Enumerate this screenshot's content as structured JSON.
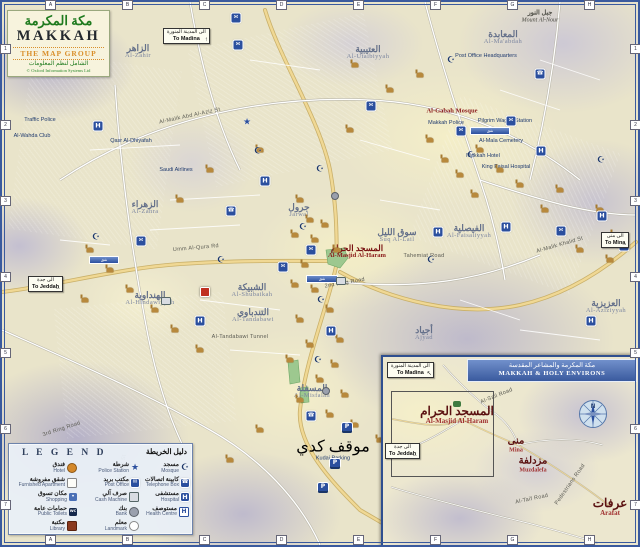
{
  "title_block": {
    "arabic": "مكة المكرمة",
    "english": "MAKKAH",
    "publisher": "THE MAP GROUP",
    "publisher_arabic": "الشامل لنظم المعلومات",
    "copyright": "© Oxford Information Systems Ltd"
  },
  "grid": {
    "top": [
      "A",
      "B",
      "C",
      "D",
      "E",
      "F",
      "G",
      "H"
    ],
    "side": [
      "1",
      "2",
      "3",
      "4",
      "5",
      "6",
      "7"
    ]
  },
  "direction_signs": [
    {
      "ar": "الى المدينة المنورة",
      "en": "To Madina",
      "arrow": "↑",
      "x": 163,
      "y": 28
    },
    {
      "ar": "الى جدة",
      "en": "To Jeddah",
      "arrow": "←",
      "x": 28,
      "y": 276
    },
    {
      "ar": "الى منى",
      "en": "To Mina",
      "arrow": "→",
      "x": 601,
      "y": 232
    }
  ],
  "map_labels": [
    {
      "t": "Al-Zahir",
      "a": "الزاهر",
      "x": 138,
      "y": 52,
      "c": "district",
      "n": "label-al-zahir"
    },
    {
      "t": "Al-Utaibiyyah",
      "a": "العتيبية",
      "x": 368,
      "y": 53,
      "c": "district",
      "n": "label-al-utaibiyyah"
    },
    {
      "t": "Al-Ma'abdah",
      "a": "المعابدة",
      "x": 503,
      "y": 38,
      "c": "district",
      "n": "label-al-maabdah"
    },
    {
      "t": "Mount Al-Nour",
      "a": "جبل النور",
      "x": 540,
      "y": 17,
      "c": "peak",
      "n": "label-mount-al-nour"
    },
    {
      "t": "Al-Zahra",
      "a": "الزهراء",
      "x": 145,
      "y": 208,
      "c": "district",
      "n": "label-al-zahra"
    },
    {
      "t": "Jarwal",
      "a": "جرول",
      "x": 299,
      "y": 211,
      "c": "district",
      "n": "label-jarwal"
    },
    {
      "t": "Suq Al-Lail",
      "a": "سوق الليل",
      "x": 397,
      "y": 236,
      "c": "district",
      "n": "label-suq-al-lail"
    },
    {
      "t": "Al-Shubaikah",
      "a": "الشبيكة",
      "x": 252,
      "y": 291,
      "c": "district",
      "n": "label-al-shubaikah"
    },
    {
      "t": "Al-Hindawiyyah",
      "a": "الهنداوية",
      "x": 150,
      "y": 299,
      "c": "district",
      "n": "label-al-hindawiyyah"
    },
    {
      "t": "Al-Tandabawi",
      "a": "التندباوي",
      "x": 253,
      "y": 316,
      "c": "district",
      "n": "label-al-tandabawi"
    },
    {
      "t": "Al-Misfalah",
      "a": "المسفلة",
      "x": 312,
      "y": 392,
      "c": "district",
      "n": "label-al-misfalah"
    },
    {
      "t": "Ajyad",
      "a": "أجياد",
      "x": 424,
      "y": 334,
      "c": "district",
      "n": "label-ajyad"
    },
    {
      "t": "Al-Faisaliyyah",
      "a": "الفيصلية",
      "x": 469,
      "y": 232,
      "c": "district",
      "n": "label-al-faisaliyyah"
    },
    {
      "t": "Al-Aziziyyah",
      "a": "العزيزية",
      "x": 606,
      "y": 307,
      "c": "district",
      "n": "label-al-aziziyyah"
    },
    {
      "t": "Al-Masjid Al-Haram",
      "a": "المسجد الحرام",
      "x": 357,
      "y": 252,
      "c": "red",
      "n": "label-al-masjid-al-haram"
    },
    {
      "t": "Al-Gabah Mosque",
      "x": 452,
      "y": 112,
      "c": "red",
      "n": "label-al-gabah-mosque"
    },
    {
      "t": "Traffic Police",
      "x": 40,
      "y": 121,
      "c": "poi"
    },
    {
      "t": "Al-Wahda Club",
      "x": 32,
      "y": 137,
      "c": "poi"
    },
    {
      "t": "Qasr Al-Dhiyafah",
      "x": 131,
      "y": 142,
      "c": "poi"
    },
    {
      "t": "Saudi Airlines",
      "x": 176,
      "y": 171,
      "c": "poi"
    },
    {
      "t": "Post Office Headquarters",
      "x": 486,
      "y": 57,
      "c": "poi"
    },
    {
      "t": "Pilgrim Wagon Station",
      "x": 505,
      "y": 122,
      "c": "poi"
    },
    {
      "t": "Makkah Police",
      "x": 446,
      "y": 124,
      "c": "poi"
    },
    {
      "t": "Al-Mala Cemetery",
      "x": 501,
      "y": 142,
      "c": "poi"
    },
    {
      "t": "Makkah Hotel",
      "x": 483,
      "y": 157,
      "c": "poi"
    },
    {
      "t": "King Faisal Hospital",
      "x": 506,
      "y": 168,
      "c": "poi"
    },
    {
      "t": "Kudai Parking",
      "a": "موقف كدي",
      "x": 333,
      "y": 451,
      "c": "poi"
    },
    {
      "t": "2nd Ring Road",
      "x": 345,
      "y": 284,
      "c": "road",
      "r": -10
    },
    {
      "t": "3rd Ring Road",
      "x": 62,
      "y": 430,
      "c": "road",
      "r": -18
    },
    {
      "t": "Umm Al-Qura Rd",
      "x": 196,
      "y": 249,
      "c": "road",
      "r": -5
    },
    {
      "t": "Al-Tandabawi Tunnel",
      "x": 240,
      "y": 338,
      "c": "road"
    },
    {
      "t": "Tahemiat Road",
      "x": 424,
      "y": 257,
      "c": "road"
    },
    {
      "t": "Al-Malik Khalid St",
      "x": 560,
      "y": 246,
      "c": "road",
      "r": -16
    },
    {
      "t": "Al-Mansur St",
      "x": 122,
      "y": 472,
      "c": "road",
      "r": -78
    },
    {
      "t": "Al-Malik Abd Al-Aziz St",
      "x": 190,
      "y": 117,
      "c": "road",
      "r": -12
    }
  ],
  "tunnel_bars": [
    {
      "t": "نفق",
      "x": 322,
      "y": 279,
      "w": 30
    },
    {
      "t": "نفق",
      "x": 104,
      "y": 260,
      "w": 28
    },
    {
      "t": "نفق",
      "x": 490,
      "y": 131,
      "w": 38
    }
  ],
  "markers": {
    "facilities": [
      {
        "t": "post",
        "x": 238,
        "y": 45
      },
      {
        "t": "police",
        "x": 247,
        "y": 123
      },
      {
        "t": "mosque",
        "x": 258,
        "y": 152
      },
      {
        "t": "hospital",
        "x": 265,
        "y": 181
      },
      {
        "t": "mosque",
        "x": 320,
        "y": 170
      },
      {
        "t": "bank",
        "x": 335,
        "y": 196
      },
      {
        "t": "mosque",
        "x": 303,
        "y": 228
      },
      {
        "t": "post",
        "x": 311,
        "y": 250
      },
      {
        "t": "cash",
        "x": 341,
        "y": 281
      },
      {
        "t": "mosque",
        "x": 321,
        "y": 301
      },
      {
        "t": "hospital",
        "x": 331,
        "y": 331
      },
      {
        "t": "mosque",
        "x": 318,
        "y": 361
      },
      {
        "t": "bank",
        "x": 326,
        "y": 391
      },
      {
        "t": "phone",
        "x": 311,
        "y": 416
      },
      {
        "t": "hospital",
        "x": 200,
        "y": 321
      },
      {
        "t": "hospital",
        "x": 98,
        "y": 126
      },
      {
        "t": "post",
        "x": 141,
        "y": 241
      },
      {
        "t": "mosque",
        "x": 221,
        "y": 261
      },
      {
        "t": "post",
        "x": 461,
        "y": 131
      },
      {
        "t": "mosque",
        "x": 471,
        "y": 156
      },
      {
        "t": "post",
        "x": 511,
        "y": 121
      },
      {
        "t": "hospital",
        "x": 541,
        "y": 151
      },
      {
        "t": "mosque",
        "x": 601,
        "y": 161
      },
      {
        "t": "post",
        "x": 561,
        "y": 231
      },
      {
        "t": "hospital",
        "x": 591,
        "y": 321
      },
      {
        "t": "mosque",
        "x": 431,
        "y": 261
      },
      {
        "t": "post",
        "x": 371,
        "y": 106
      },
      {
        "t": "mosque",
        "x": 451,
        "y": 61
      },
      {
        "t": "phone",
        "x": 231,
        "y": 211
      },
      {
        "t": "cash",
        "x": 166,
        "y": 301
      },
      {
        "t": "hospital",
        "x": 438,
        "y": 232
      },
      {
        "t": "post",
        "x": 283,
        "y": 267
      },
      {
        "t": "parking",
        "x": 347,
        "y": 427
      },
      {
        "t": "parking",
        "x": 335,
        "y": 463
      },
      {
        "t": "parking",
        "x": 323,
        "y": 487
      },
      {
        "t": "parkred",
        "x": 205,
        "y": 292
      },
      {
        "t": "hospital",
        "x": 602,
        "y": 216
      },
      {
        "t": "post",
        "x": 624,
        "y": 246
      },
      {
        "t": "mosque",
        "x": 96,
        "y": 238
      },
      {
        "t": "phone",
        "x": 540,
        "y": 74
      },
      {
        "t": "post",
        "x": 236,
        "y": 18
      },
      {
        "t": "hospital",
        "x": 506,
        "y": 227
      }
    ],
    "mosques": [
      [
        300,
        200
      ],
      [
        310,
        220
      ],
      [
        295,
        235
      ],
      [
        315,
        240
      ],
      [
        325,
        225
      ],
      [
        305,
        265
      ],
      [
        295,
        285
      ],
      [
        315,
        290
      ],
      [
        330,
        310
      ],
      [
        300,
        320
      ],
      [
        340,
        340
      ],
      [
        310,
        345
      ],
      [
        290,
        360
      ],
      [
        335,
        365
      ],
      [
        320,
        380
      ],
      [
        345,
        395
      ],
      [
        300,
        400
      ],
      [
        330,
        415
      ],
      [
        355,
        425
      ],
      [
        430,
        140
      ],
      [
        445,
        160
      ],
      [
        460,
        175
      ],
      [
        480,
        150
      ],
      [
        500,
        170
      ],
      [
        520,
        185
      ],
      [
        475,
        195
      ],
      [
        545,
        210
      ],
      [
        560,
        190
      ],
      [
        600,
        210
      ],
      [
        615,
        235
      ],
      [
        580,
        250
      ],
      [
        610,
        260
      ],
      [
        90,
        250
      ],
      [
        110,
        270
      ],
      [
        130,
        290
      ],
      [
        155,
        310
      ],
      [
        175,
        330
      ],
      [
        200,
        350
      ],
      [
        85,
        300
      ],
      [
        355,
        65
      ],
      [
        390,
        90
      ],
      [
        420,
        75
      ],
      [
        350,
        130
      ],
      [
        260,
        150
      ],
      [
        210,
        170
      ],
      [
        180,
        200
      ],
      [
        380,
        440
      ],
      [
        260,
        430
      ],
      [
        230,
        460
      ],
      [
        420,
        420
      ],
      [
        337,
        250
      ]
    ]
  },
  "legend": {
    "title_en": "L E G E N D",
    "title_ar": "دليل الخريطة",
    "columns": [
      {
        "items": [
          {
            "en": "Hotel",
            "ar": "فندق",
            "icon": "hotel"
          },
          {
            "en": "Furnished Apartment",
            "ar": "شقق مفروشة",
            "icon": "apartment"
          },
          {
            "en": "Shopping",
            "ar": "مكان تسوق",
            "icon": "shopping"
          },
          {
            "en": "Public Toilets",
            "ar": "حمامات عامة",
            "icon": "toilets"
          },
          {
            "en": "Library",
            "ar": "مكتبة",
            "icon": "library"
          }
        ]
      },
      {
        "items": [
          {
            "en": "Police Station",
            "ar": "شرطة",
            "icon": "police"
          },
          {
            "en": "Post Office",
            "ar": "مكتب بريد",
            "icon": "post"
          },
          {
            "en": "Cash Machine",
            "ar": "صرف آلي",
            "icon": "cash"
          },
          {
            "en": "Bank",
            "ar": "بنك",
            "icon": "bank"
          },
          {
            "en": "Landmark",
            "ar": "معلم",
            "icon": "landmark"
          }
        ]
      },
      {
        "items": [
          {
            "en": "Mosque",
            "ar": "مسجد",
            "icon": "mosque"
          },
          {
            "en": "Telephone Box",
            "ar": "كابينة اتصالات",
            "icon": "phone"
          },
          {
            "en": "Hospital",
            "ar": "مستشفى",
            "icon": "hospital"
          },
          {
            "en": "Health Centre",
            "ar": "مستوصف",
            "icon": "health"
          }
        ]
      }
    ]
  },
  "inset": {
    "title_ar": "مكة المكرمة والمشاعر المقدسة",
    "title_en": "MAKKAH & HOLY ENVIRONS",
    "compass_n": "N",
    "labels": [
      {
        "t": "Al-Masjid Al-Haram",
        "a": "المسجد الحرام",
        "x": 74,
        "y": 58,
        "c": "holy big",
        "n": "inset-label-haram"
      },
      {
        "t": "Mina",
        "a": "منى",
        "x": 133,
        "y": 88,
        "c": "holy",
        "n": "inset-label-mina"
      },
      {
        "t": "Muzdalefa",
        "a": "مزدلفة",
        "x": 150,
        "y": 108,
        "c": "holy",
        "n": "inset-label-muzdalefa"
      },
      {
        "t": "Arafat",
        "a": "عرفات",
        "x": 227,
        "y": 150,
        "c": "holy big",
        "n": "inset-label-arafat"
      },
      {
        "t": "Al-Sail Road",
        "x": 114,
        "y": 40,
        "c": "road",
        "r": -22
      },
      {
        "t": "Al-Taif Road",
        "x": 149,
        "y": 143,
        "c": "road",
        "r": -12
      },
      {
        "t": "Pedestrians Road",
        "x": 188,
        "y": 128,
        "c": "road",
        "r": -55
      }
    ],
    "signs": [
      {
        "ar": "الى المدينة المنورة",
        "en": "To Madina",
        "arrow": "↖",
        "x": 4,
        "y": 5
      },
      {
        "ar": "الى جدة",
        "en": "To Jeddah",
        "arrow": "←",
        "x": 2,
        "y": 86
      }
    ]
  },
  "colors": {
    "frame_blue": "#3a5a9e",
    "facility_blue": "#2b4f9e",
    "holy_red": "#8b1a1a",
    "mosque_gold": "#b8893c",
    "title_green": "#1e7a1e",
    "publisher_orange": "#d98f2b"
  }
}
